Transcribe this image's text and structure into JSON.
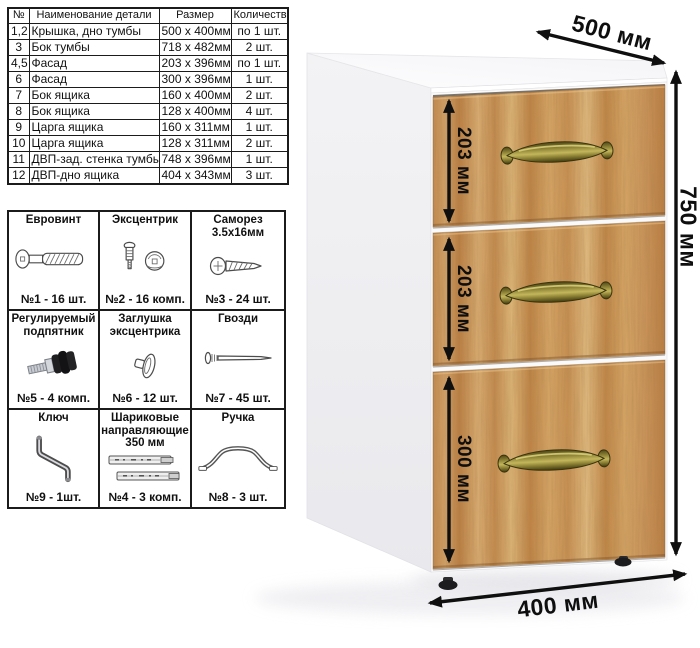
{
  "parts_table": {
    "headers": [
      "№",
      "Наименование детали",
      "Размер",
      "Количество"
    ],
    "rows": [
      [
        "1,2",
        "Крышка, дно тумбы",
        "500 х 400мм",
        "по 1 шт."
      ],
      [
        "3",
        "Бок тумбы",
        "718 х 482мм",
        "2 шт."
      ],
      [
        "4,5",
        "Фасад",
        "203 х 396мм",
        "по 1 шт."
      ],
      [
        "6",
        "Фасад",
        "300 х 396мм",
        "1 шт."
      ],
      [
        "7",
        "Бок ящика",
        "160 х 400мм",
        "2 шт."
      ],
      [
        "8",
        "Бок ящика",
        "128 х 400мм",
        "4 шт."
      ],
      [
        "9",
        "Царга ящика",
        "160 х 311мм",
        "1 шт."
      ],
      [
        "10",
        "Царга ящика",
        "128 х 311мм",
        "2 шт."
      ],
      [
        "11",
        "ДВП-зад. стенка тумбы",
        "748 х 396мм",
        "1 шт."
      ],
      [
        "12",
        "ДВП-дно ящика",
        "404 х 343мм",
        "3 шт."
      ]
    ]
  },
  "hardware_table": {
    "cells": [
      {
        "title": "Евровинт",
        "icon": "euro-screw",
        "qty": "№1 - 16 шт."
      },
      {
        "title": "Эксцентрик",
        "icon": "cam-lock",
        "qty": "№2 - 16 комп."
      },
      {
        "title": "Саморез 3.5х16мм",
        "icon": "self-tapping-screw",
        "qty": "№3 - 24 шт."
      },
      {
        "title": "Регулируемый подпятник",
        "icon": "adjustable-foot",
        "qty": "№5 - 4 комп."
      },
      {
        "title": "Заглушка эксцентрика",
        "icon": "cam-cap",
        "qty": "№6 - 12 шт."
      },
      {
        "title": "Гвозди",
        "icon": "nail",
        "qty": "№7 - 45 шт."
      },
      {
        "title": "Ключ",
        "icon": "hex-key",
        "qty": "№9 - 1шт."
      },
      {
        "title": "Шариковые направляющие 350 мм",
        "icon": "ball-slides",
        "qty": "№4 - 3 комп."
      },
      {
        "title": "Ручка",
        "icon": "handle",
        "qty": "№8 - 3 шт."
      }
    ]
  },
  "cabinet": {
    "drawer_count": 3,
    "dimensions": {
      "width": "500 мм",
      "height": "750 мм",
      "depth": "400 мм",
      "drawer_top": "203 мм",
      "drawer_middle": "203 мм",
      "drawer_bottom": "300 мм"
    },
    "colors": {
      "wood": "#c89355",
      "body": "#ffffff",
      "handle_bronze": "#8a7f33",
      "dimension_ink": "#0f0f10"
    }
  }
}
